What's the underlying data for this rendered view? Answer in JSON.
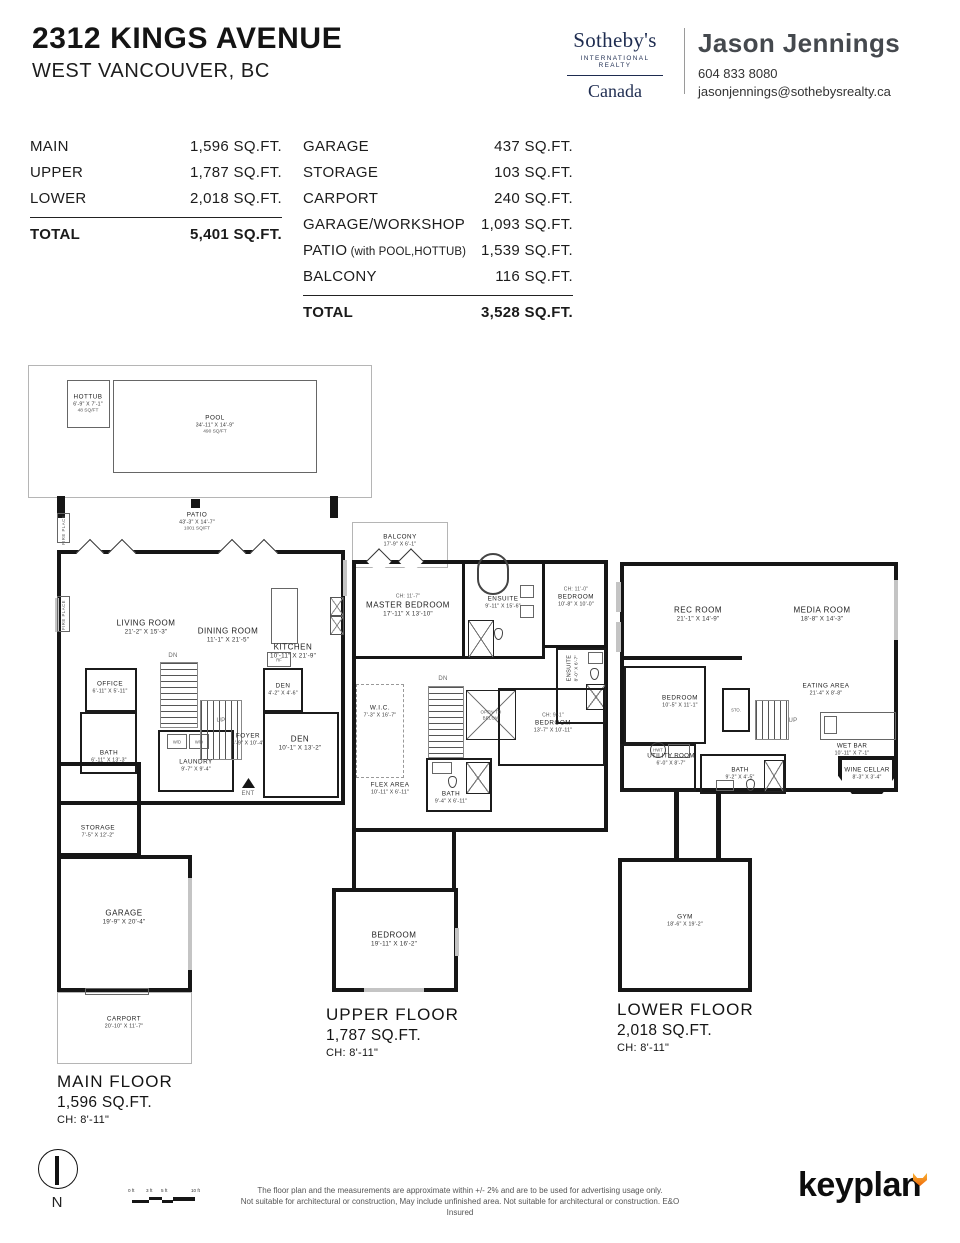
{
  "header": {
    "title": "2312 KINGS AVENUE",
    "subtitle": "WEST VANCOUVER, BC"
  },
  "brand": {
    "name": "Sotheby's",
    "tagline": "INTERNATIONAL REALTY",
    "region": "Canada",
    "color": "#1e2c50"
  },
  "agent": {
    "name": "Jason Jennings",
    "phone": "604 833 8080",
    "email": "jasonjennings@sothebysrealty.ca"
  },
  "areas": {
    "left": {
      "rows": [
        {
          "label": "MAIN",
          "value": "1,596 SQ.FT."
        },
        {
          "label": "UPPER",
          "value": "1,787 SQ.FT."
        },
        {
          "label": "LOWER",
          "value": "2,018 SQ.FT."
        }
      ],
      "total": {
        "label": "TOTAL",
        "value": "5,401 SQ.FT."
      }
    },
    "right": {
      "rows": [
        {
          "label": "GARAGE",
          "value": "437 SQ.FT."
        },
        {
          "label": "STORAGE",
          "value": "103 SQ.FT."
        },
        {
          "label": "CARPORT",
          "value": "240 SQ.FT."
        },
        {
          "label": "GARAGE/WORKSHOP",
          "value": "1,093 SQ.FT."
        },
        {
          "label": "PATIO",
          "note": "(with POOL,HOTTUB)",
          "value": "1,539 SQ.FT."
        },
        {
          "label": "BALCONY",
          "value": "116 SQ.FT."
        }
      ],
      "total": {
        "label": "TOTAL",
        "value": "3,528 SQ.FT."
      }
    }
  },
  "floors": {
    "main": {
      "title": "MAIN FLOOR",
      "area": "1,596 SQ.FT.",
      "ch": "CH: 8'-11\"",
      "rooms": [
        {
          "id": "hottub",
          "name": "HOTTUB",
          "dims": "6'-9\" X 7'-1\"",
          "sub": "48 SQ/FT"
        },
        {
          "id": "pool",
          "name": "POOL",
          "dims": "34'-11\" X 14'-9\"",
          "sub": "490 SQ/FT"
        },
        {
          "id": "patio",
          "name": "PATIO",
          "dims": "43'-3\" X 14'-7\"",
          "sub": "1001 SQ/FT"
        },
        {
          "id": "living",
          "name": "LIVING ROOM",
          "dims": "21'-2\" X 15'-3\""
        },
        {
          "id": "dining",
          "name": "DINING ROOM",
          "dims": "11'-1\" X 21'-5\""
        },
        {
          "id": "kitchen",
          "name": "KITCHEN",
          "dims": "10'-11\" X 21'-9\""
        },
        {
          "id": "office",
          "name": "OFFICE",
          "dims": "6'-11\" X 5'-11\""
        },
        {
          "id": "den_small",
          "name": "DEN",
          "dims": "4'-2\" X 4'-6\""
        },
        {
          "id": "bath",
          "name": "BATH",
          "dims": "6'-11\" X 13'-3\""
        },
        {
          "id": "laundry",
          "name": "LAUNDRY",
          "dims": "9'-7\" X 9'-4\""
        },
        {
          "id": "foyer",
          "name": "FOYER",
          "dims": "6'-9\" X 10'-4\""
        },
        {
          "id": "den",
          "name": "DEN",
          "dims": "10'-1\" X 13'-2\""
        },
        {
          "id": "storage",
          "name": "STORAGE",
          "dims": "7'-5\" X 12'-2\""
        },
        {
          "id": "garage",
          "name": "GARAGE",
          "dims": "19'-9\" X 20'-4\""
        },
        {
          "id": "carport",
          "name": "CARPORT",
          "dims": "20'-10\" X 11'-7\""
        },
        {
          "id": "dn",
          "name": "DN"
        },
        {
          "id": "up",
          "name": "UP"
        },
        {
          "id": "ent",
          "name": "ENT"
        },
        {
          "id": "wd1",
          "name": "W/D"
        },
        {
          "id": "wd2",
          "name": "W/D"
        },
        {
          "id": "rf",
          "name": "RF"
        },
        {
          "id": "fp1",
          "name": "FIRE PLACE"
        },
        {
          "id": "fp2",
          "name": "FIRE PLACE"
        }
      ]
    },
    "upper": {
      "title": "UPPER FLOOR",
      "area": "1,787 SQ.FT.",
      "ch": "CH: 8'-11\"",
      "rooms": [
        {
          "id": "balcony",
          "name": "BALCONY",
          "dims": "17'-9\" X 6'-1\""
        },
        {
          "id": "master",
          "ch": "CH: 11'-7\"",
          "name": "MASTER BEDROOM",
          "dims": "17'-11\" X 13'-10\""
        },
        {
          "id": "ensuite",
          "name": "ENSUITE",
          "dims": "9'-11\" X 15'-6\""
        },
        {
          "id": "bedroom_ne",
          "ch": "CH: 11'-0\"",
          "name": "BEDROOM",
          "dims": "10'-8\" X 10'-0\""
        },
        {
          "id": "ensuite2",
          "name": "ENSUITE",
          "dims": "8'-0\" X 6'-7\""
        },
        {
          "id": "wic",
          "name": "W.I.C.",
          "dims": "7'-3\" X 16'-7\""
        },
        {
          "id": "open_below",
          "name": "OPEN TO BELOW"
        },
        {
          "id": "bedroom_mid",
          "ch": "CH: 9'-1\"",
          "name": "BEDROOM",
          "dims": "13'-7\" X 10'-11\""
        },
        {
          "id": "flex",
          "name": "FLEX AREA",
          "dims": "10'-11\" X 6'-11\""
        },
        {
          "id": "bath",
          "name": "BATH",
          "dims": "9'-4\" X 6'-11\""
        },
        {
          "id": "bedroom_s",
          "name": "BEDROOM",
          "dims": "19'-11\" X 16'-2\""
        },
        {
          "id": "dn",
          "name": "DN"
        }
      ]
    },
    "lower": {
      "title": "LOWER FLOOR",
      "area": "2,018 SQ.FT.",
      "ch": "CH: 8'-11\"",
      "rooms": [
        {
          "id": "rec",
          "name": "REC ROOM",
          "dims": "21'-1\" X 14'-9\""
        },
        {
          "id": "media",
          "name": "MEDIA ROOM",
          "dims": "18'-8\" X 14'-3\""
        },
        {
          "id": "eating",
          "name": "EATING AREA",
          "dims": "21'-4\" X 8'-8\""
        },
        {
          "id": "bedroom",
          "name": "BEDROOM",
          "dims": "10'-5\" X 11'-1\""
        },
        {
          "id": "sto",
          "name": "STO."
        },
        {
          "id": "utility",
          "name": "UTILITY ROOM",
          "dims": "6'-0\" X 8'-7\""
        },
        {
          "id": "hwt",
          "name": "HWT"
        },
        {
          "id": "up",
          "name": "UP"
        },
        {
          "id": "wetbar",
          "name": "WET BAR",
          "dims": "10'-11\" X 7'-1\""
        },
        {
          "id": "wine",
          "name": "WINE CELLAR",
          "dims": "8'-3\" X 3'-4\""
        },
        {
          "id": "bath",
          "name": "BATH",
          "dims": "9'-2\" X 4'-5\""
        },
        {
          "id": "gym",
          "name": "GYM",
          "dims": "18'-6\" X 19'-2\""
        }
      ]
    }
  },
  "footer": {
    "compass": "N",
    "scale_labels": [
      "0 ft",
      "3 ft",
      "5 ft",
      "10 ft"
    ],
    "disclaimer": [
      "The floor plan and the measurements are approximate within +/- 2% and are to be used for advertising usage only.",
      "Not suitable for architectural or construction, May include unfinished area. Not suitable for architectural or construction. E&O Insured"
    ],
    "logo": "keyplan"
  }
}
